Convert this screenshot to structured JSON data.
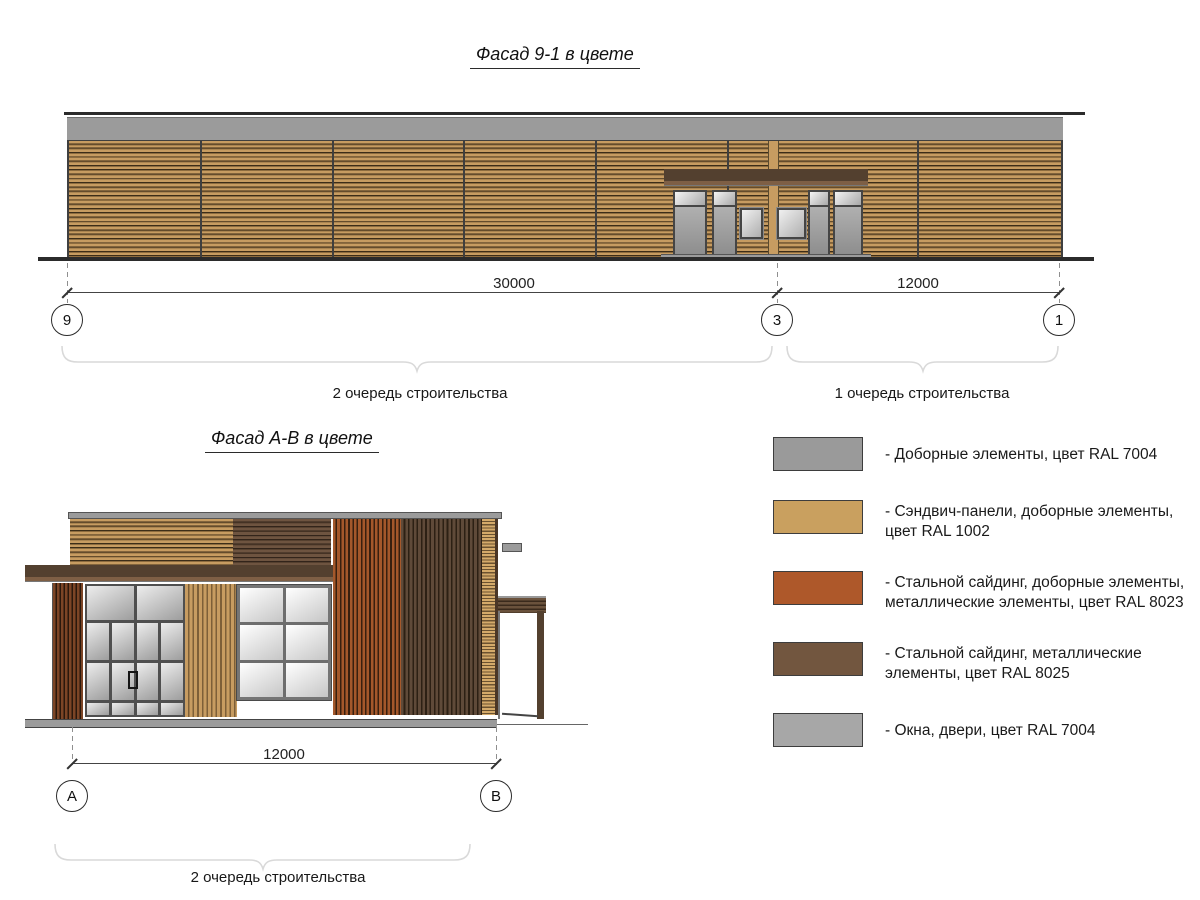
{
  "facade1": {
    "title": "Фасад 9-1 в цвете",
    "dim_left": "30000",
    "dim_right": "12000",
    "axis_left": "9",
    "axis_mid": "3",
    "axis_right": "1",
    "phase2_label": "2 очередь строительства",
    "phase1_label": "1 очередь строительства"
  },
  "facade2": {
    "title": "Фасад А-В в цвете",
    "dim": "12000",
    "axis_left": "А",
    "axis_right": "В",
    "phase_label": "2 очередь строительства"
  },
  "legend": {
    "items": [
      {
        "color": "#9a9a9a",
        "label": "- Доборные элементы, цвет RAL 7004"
      },
      {
        "color": "#c9a05f",
        "label": "- Сэндвич-панели, доборные элементы, цвет RAL 1002"
      },
      {
        "color": "#ae582a",
        "label": "- Стальной сайдинг, доборные элементы, металлические элементы, цвет RAL 8023"
      },
      {
        "color": "#72563f",
        "label": "- Стальной сайдинг, металлические элементы, цвет RAL 8025"
      },
      {
        "color": "#a7a7a7",
        "label": "- Окна, двери, цвет RAL 7004"
      }
    ]
  },
  "colors": {
    "ral7004_gray": "#9b9b9b",
    "ral1002_tan": "#c79c61",
    "ral8023_orange": "#a4582b",
    "ral8025_brown": "#5f4a39",
    "frame_dark": "#454545"
  }
}
